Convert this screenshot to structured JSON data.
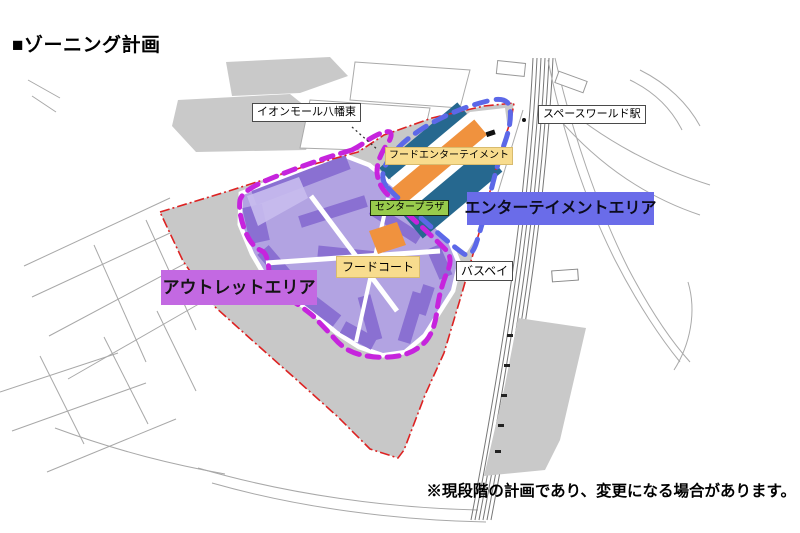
{
  "page": {
    "title": "■ゾーニング計画",
    "footnote": "※現段階の計画であり、変更になる場合があります。"
  },
  "map": {
    "labels": {
      "aeon_mall": "イオンモール八幡東",
      "station": "スペースワールド駅",
      "food_entertainment": "フードエンターテイメント",
      "center_plaza": "センタープラザ",
      "entertainment_area": "エンターテイメントエリア",
      "food_court": "フードコート",
      "bus_bay": "バスベイ",
      "outlet_area": "アウトレットエリア"
    },
    "zones": [
      {
        "name": "アウトレットエリア",
        "outline_color": "#c624dd",
        "label_bg": "#c369e2"
      },
      {
        "name": "エンターテイメントエリア",
        "outline_color": "#5c68e8",
        "label_bg": "#6a6ce9"
      }
    ],
    "colors": {
      "site_boundary": "#dd2222",
      "outlet_buildings": "#8a70d2",
      "entertainment_buildings": "#26688f",
      "plaza_buildings": "#f0923e",
      "food_label_bg": "#f8dc8e",
      "center_plaza_label_bg": "#98cb4c",
      "existing_blocks": "#c9c9c9"
    }
  }
}
